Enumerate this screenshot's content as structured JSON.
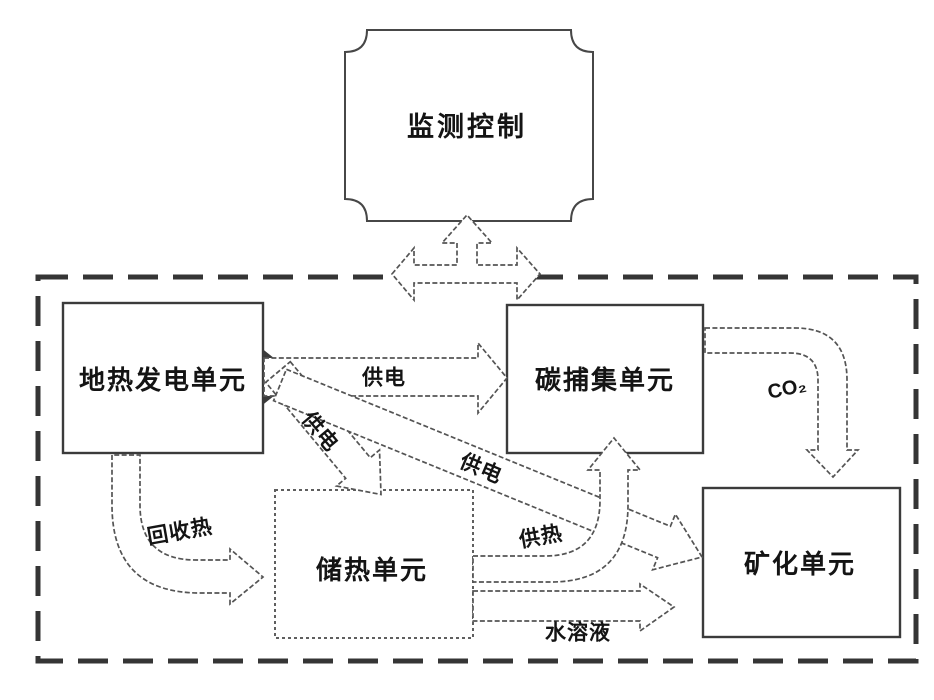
{
  "diagram": {
    "nodes": {
      "monitor": {
        "label": "监测控制"
      },
      "geothermal": {
        "label": "地热发电单元"
      },
      "carbon_capture": {
        "label": "碳捕集单元"
      },
      "heat_storage": {
        "label": "储热单元"
      },
      "mineralization": {
        "label": "矿化单元"
      }
    },
    "edges": {
      "power_to_carbon": {
        "label": "供电"
      },
      "power_to_storage": {
        "label": "供电"
      },
      "power_to_mineral": {
        "label": "供电"
      },
      "co2": {
        "label": "CO₂"
      },
      "recovered_heat": {
        "label": "回收热"
      },
      "heat_supply": {
        "label": "供热"
      },
      "aqueous_solution": {
        "label": "水溶液"
      }
    },
    "colors": {
      "ink": "#141414",
      "line": "#545454",
      "background": "#ffffff"
    }
  }
}
